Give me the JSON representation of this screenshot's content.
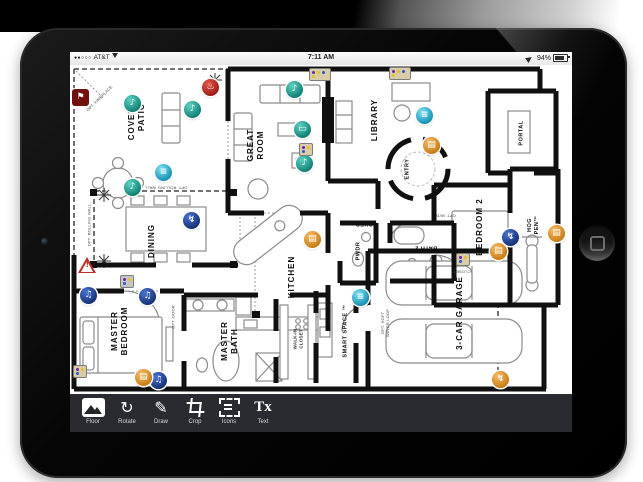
{
  "status": {
    "signal_dots": "●●○○○",
    "carrier": "AT&T",
    "time": "7:11 AM",
    "battery_percent": "94%"
  },
  "toolbar": {
    "items": [
      {
        "label": "Floor"
      },
      {
        "label": "Rotate"
      },
      {
        "label": "Draw"
      },
      {
        "label": "Crop"
      },
      {
        "label": "Icons"
      },
      {
        "label": "Text"
      }
    ],
    "tx_glyph": "Tx",
    "rotate_glyph": "↻",
    "draw_glyph": "✎"
  },
  "floor_plan": {
    "rooms": [
      {
        "label": "COVERED\nPATIO"
      },
      {
        "label": "GREAT\nROOM"
      },
      {
        "label": "LIBRARY"
      },
      {
        "label": "ENTRY"
      },
      {
        "label": "PORTAL"
      },
      {
        "label": "HOG\nPEN™"
      },
      {
        "label": "BEDROOM 2"
      },
      {
        "label": "FOYER"
      },
      {
        "label": "DINING"
      },
      {
        "label": "KITCHEN"
      },
      {
        "label": "PWDR"
      },
      {
        "label": "BATH 2"
      },
      {
        "label": "MASTER\nBEDROOM"
      },
      {
        "label": "MASTER\nBATH"
      },
      {
        "label": "SMART SPACE ™"
      },
      {
        "label": "3-CAR GARAGE"
      },
      {
        "label": "WALK-IN\nCLOSET"
      }
    ],
    "annotations": [
      {
        "label": "OPT. FIREPLACE"
      },
      {
        "label": "OPT. ROLLING WALL"
      },
      {
        "label": "OPT. ROLLING WALL"
      },
      {
        "label": "OPT. DOOR"
      },
      {
        "label": "OPT. SOFT\nWATER LOOP"
      },
      {
        "label": "CLOSET"
      },
      {
        "label": "OPT. W/D"
      }
    ],
    "glyphs": {
      "speaker": "♪",
      "music": "♫",
      "tv": "▭",
      "shade": "≡",
      "door": "▤",
      "power": "↯",
      "fire": "♨",
      "flag": "⚑",
      "warning": "!"
    }
  },
  "colors": {
    "teal": "#0c7f72",
    "cyan": "#1590b4",
    "navy": "#152f72",
    "orange": "#c87c14",
    "red": "#9c1a12",
    "toolbar_bg": "#292b30"
  }
}
